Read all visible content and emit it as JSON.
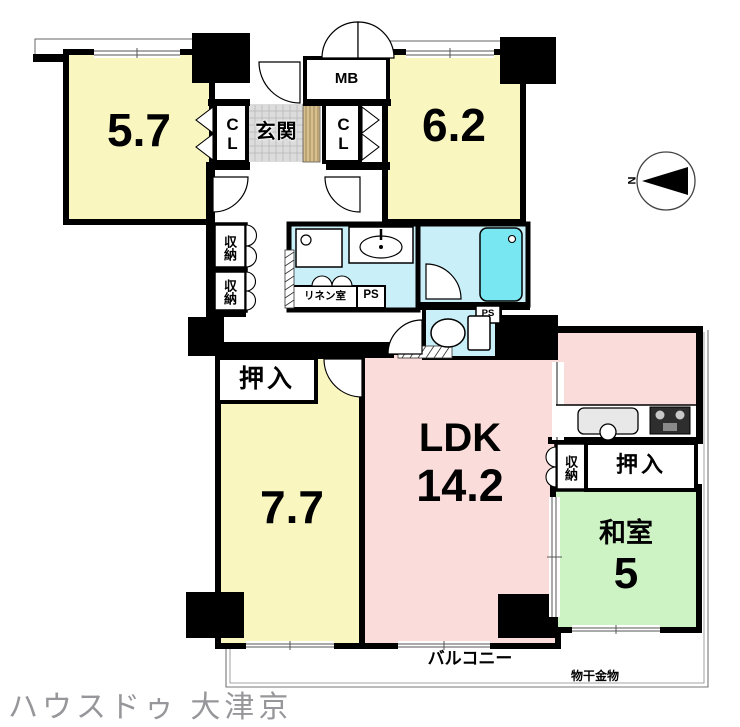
{
  "watermark": "ハウスドゥ 大津京",
  "compass": {
    "north": "N"
  },
  "rooms": {
    "western1": {
      "size_label": "5.7"
    },
    "western2": {
      "size_label": "6.2"
    },
    "western3": {
      "size_label": "7.7"
    },
    "ldk": {
      "name_label": "LDK",
      "size_label": "14.2"
    },
    "japanese": {
      "name_label": "和室",
      "size_label": "5"
    },
    "entrance": {
      "label": "玄関"
    }
  },
  "fixtures": {
    "meter_box": "MB",
    "closet_left": "CL",
    "closet_right": "CL",
    "storage1": "収納",
    "storage2": "収納",
    "storage_kitchen": "収納",
    "oshiire_west": "押入",
    "oshiire_east": "押入",
    "linen_room": "リネン室",
    "pipe_space1": "PS",
    "pipe_space2": "PS"
  },
  "outdoor": {
    "balcony": "バルコニー",
    "laundry_hardware": "物干金物"
  },
  "colors": {
    "room_yellow": "#FAF6C0",
    "ldk_pink": "#FADCDA",
    "tatami_green": "#CDF2C3",
    "water_blue": "#C9F0F8",
    "bathtub_cyan": "#79E7F2",
    "entrance_tile_gray": "#DCDCDC",
    "entrance_step_tan": "#D9BE8E",
    "wall_black": "#000000",
    "watermark_gray": "#97979B"
  }
}
